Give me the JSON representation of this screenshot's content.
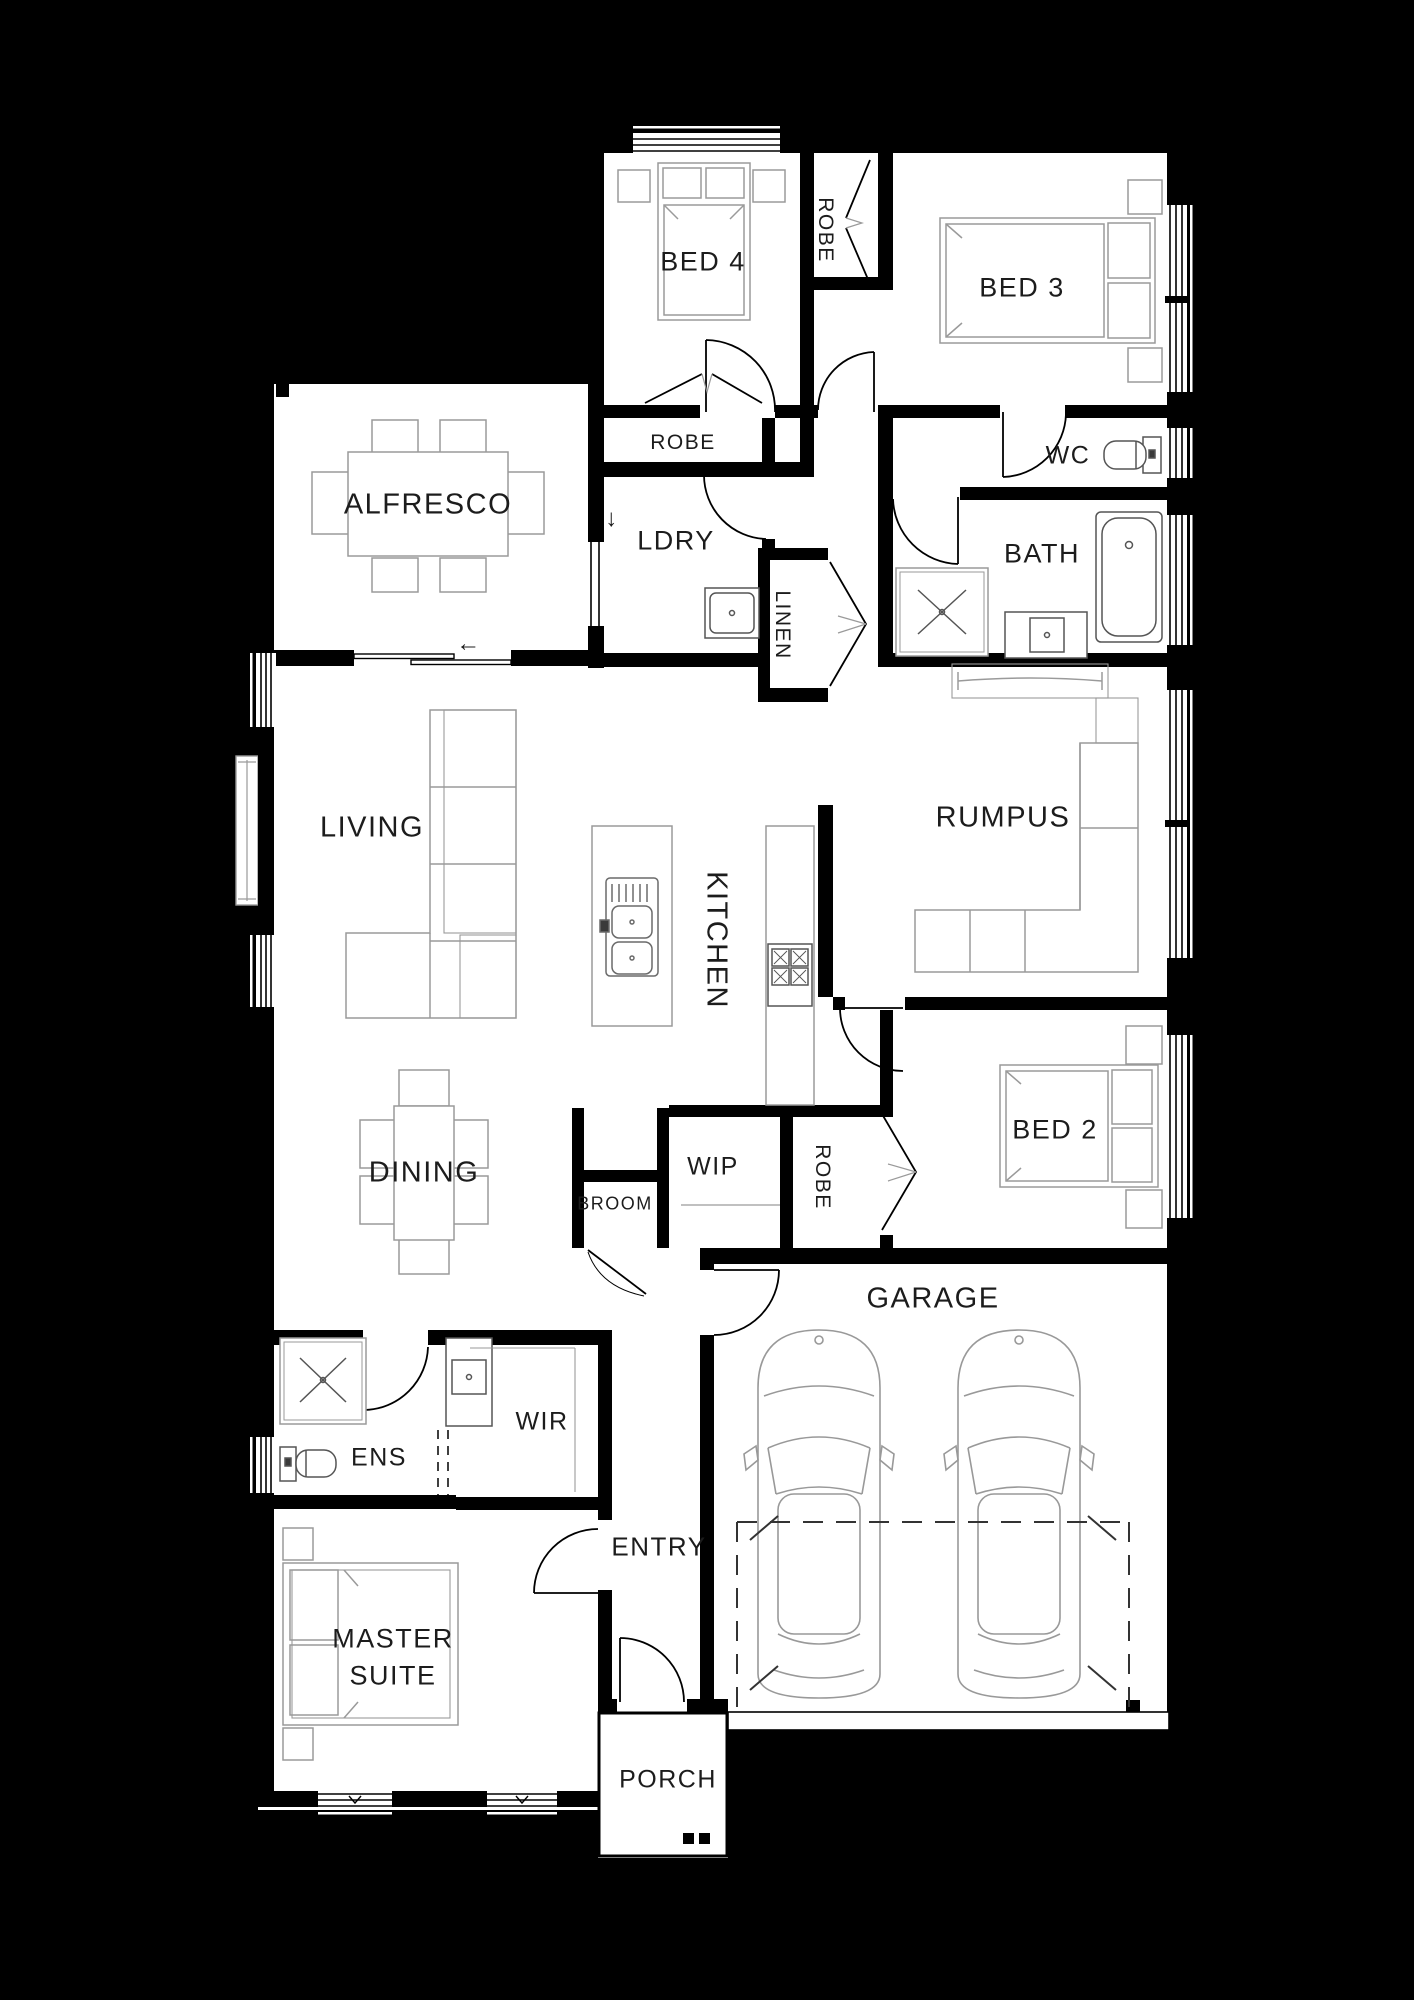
{
  "plan": {
    "rooms": {
      "bed4": "BED 4",
      "robe_bed3": "ROBE",
      "bed3": "BED 3",
      "alfresco": "ALFRESCO",
      "robe_bed4": "ROBE",
      "wc": "WC",
      "ldry": "LDRY",
      "bath": "BATH",
      "linen": "LINEN",
      "living": "LIVING",
      "kitchen": "KITCHEN",
      "rumpus": "RUMPUS",
      "dining": "DINING",
      "wip": "WIP",
      "broom": "BROOM",
      "robe_bed2": "ROBE",
      "bed2": "BED 2",
      "garage": "GARAGE",
      "wir": "WIR",
      "ens": "ENS",
      "entry": "ENTRY",
      "master_line1": "MASTER",
      "master_line2": "SUITE",
      "porch": "PORCH"
    },
    "symbols": {
      "ldry_exit_arrow": "↓",
      "slider_arrow": "←"
    },
    "colors": {
      "background": "#000000",
      "floor": "#ffffff",
      "wall": "#000000",
      "furniture_line": "#9a9a9a",
      "text": "#1c1c1c"
    }
  }
}
